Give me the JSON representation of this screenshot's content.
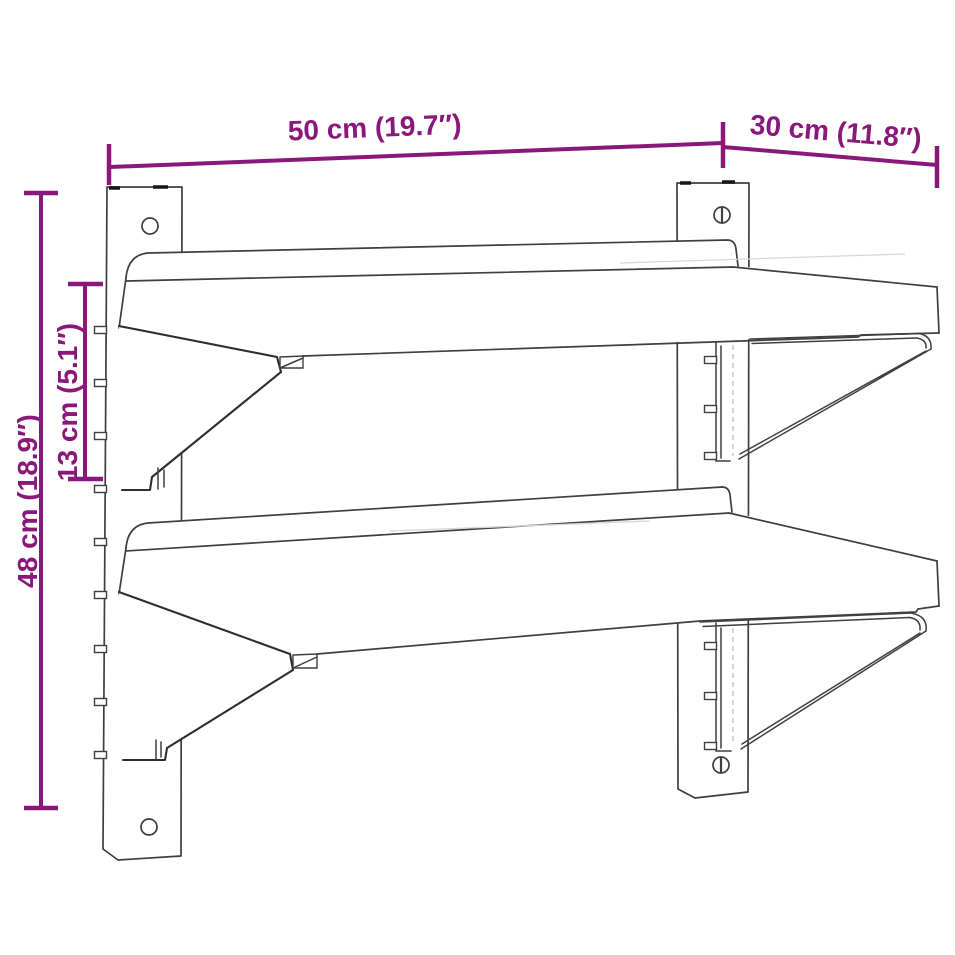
{
  "diagram": {
    "colors": {
      "accent": "#8a187a",
      "line": "#3f3f3f",
      "background": "#ffffff"
    },
    "dimensions": {
      "width": {
        "label": "50 cm (19.7″)"
      },
      "depth": {
        "label": "30 cm (11.8″)"
      },
      "height": {
        "label": "48 cm (18.9″)"
      },
      "shelf_gap": {
        "label": "13 cm (5.1″)"
      }
    }
  }
}
